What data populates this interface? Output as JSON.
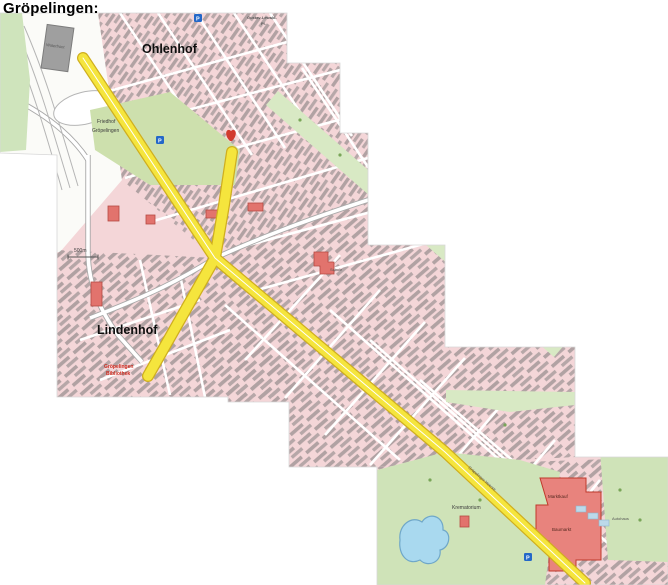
{
  "page": {
    "title": "Gröpelingen:"
  },
  "map": {
    "districts": [
      {
        "name": "Ohlenhof"
      },
      {
        "name": "Lindenhof"
      }
    ],
    "labels": {
      "cemetery_line1": "Friedhof",
      "cemetery_line2": "Gröpelingen",
      "crematorium": "Krematorium",
      "square_line1": "Gustav-Lewald-",
      "square_line2": "Pl.",
      "terminus_line1": "Gröpelingen",
      "terminus_line2": "Bibliothek",
      "school": "Schule",
      "playground": "Spielpl.",
      "store_line1": "Marktkauf",
      "store_line2": "Baumarkt",
      "mall": "Waterfront",
      "street": "Gröpelinger Heerstr.",
      "autohaus": "Autohaus",
      "scale": "500m",
      "parking": "P"
    },
    "colors": {
      "residential": "#f4d6d8",
      "building": "#6e6e6e",
      "park": "#d5e7c2",
      "cemetery": "#cde0ad",
      "highlight_road": "#f5e53d",
      "highlight_road_edge": "#cfae1f",
      "landmark_red": "#e2736d",
      "water": "#a9d9ef",
      "parking_blue": "#2468c8"
    }
  }
}
